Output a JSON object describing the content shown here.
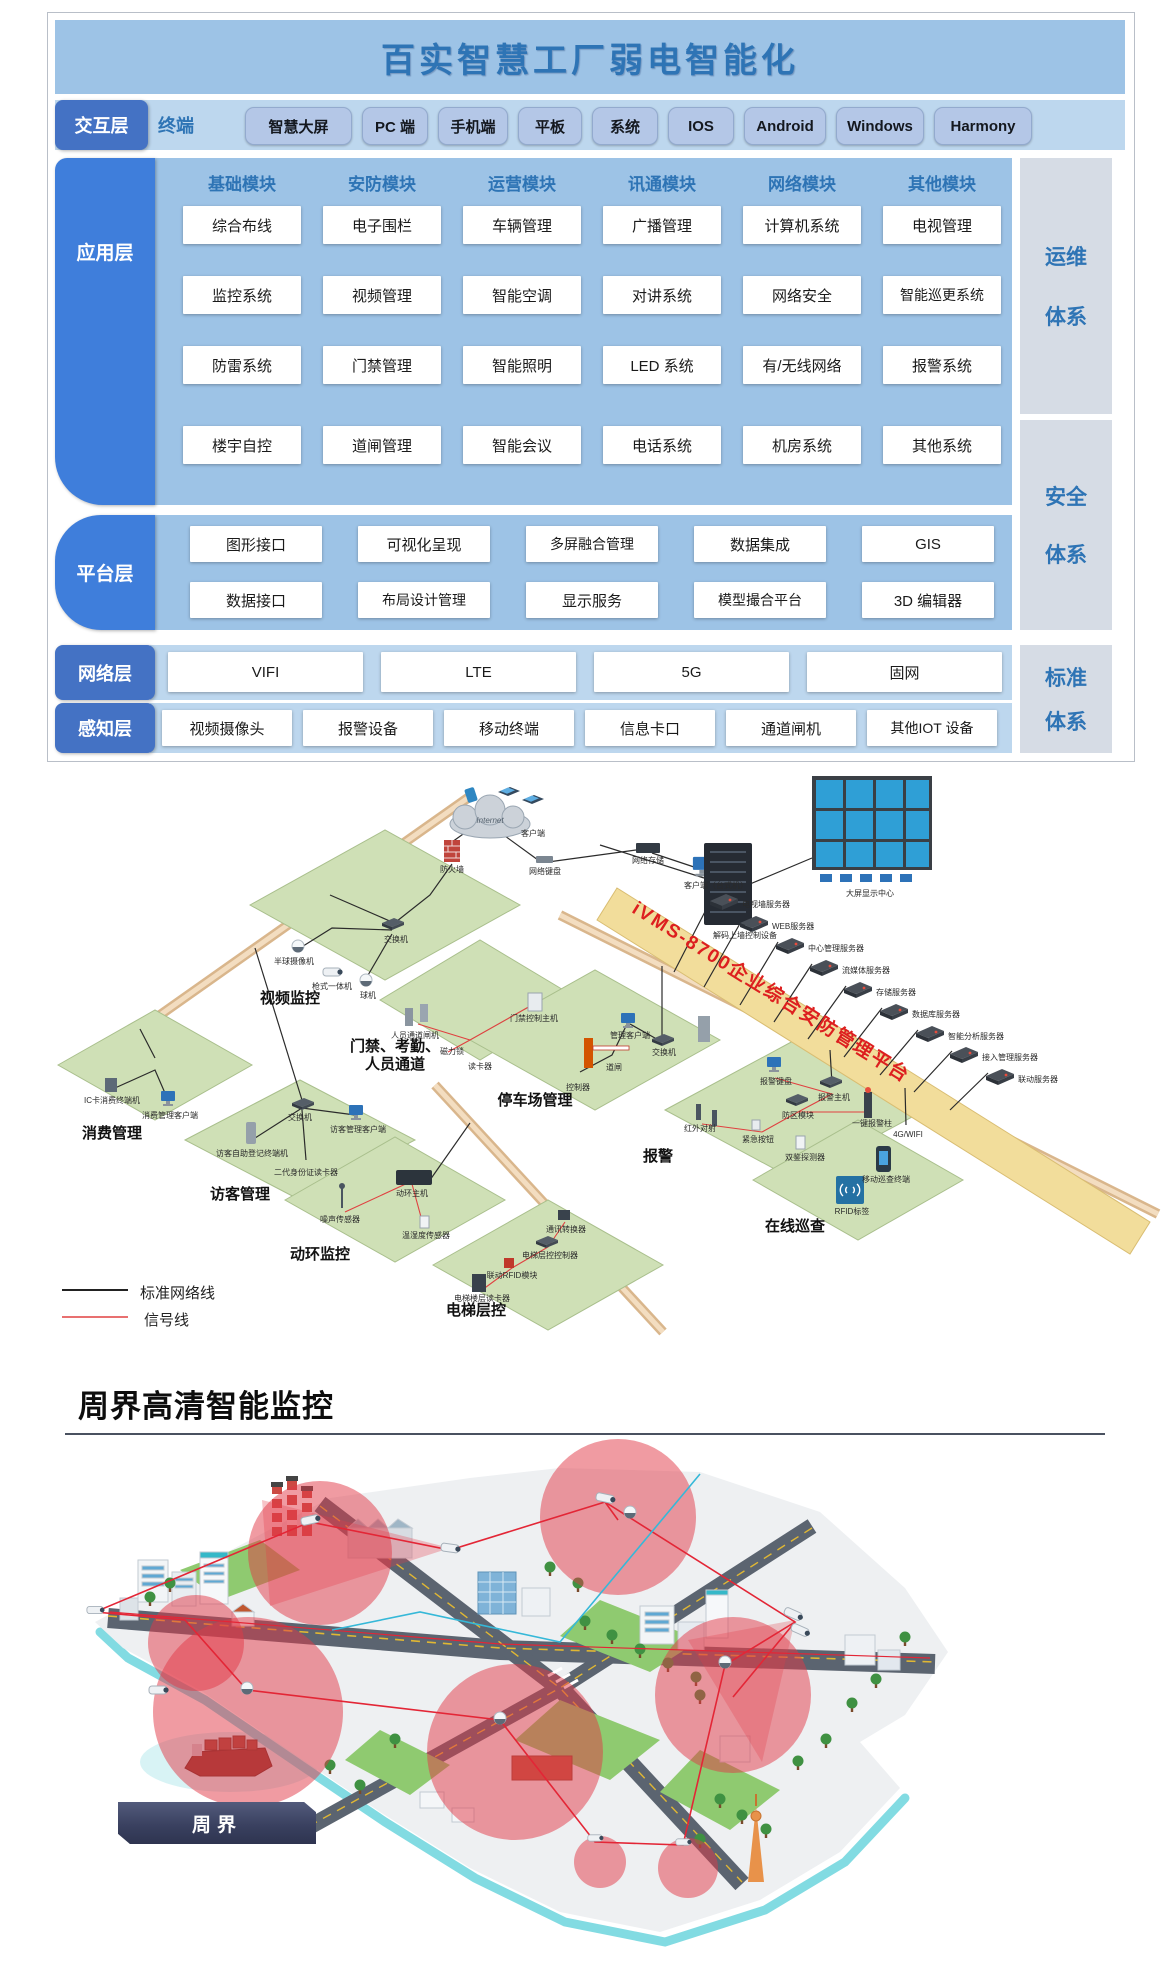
{
  "title": "百实智慧工厂弱电智能化",
  "interaction": {
    "tab": "交互层",
    "lead": "终端",
    "buttons": [
      "智慧大屏",
      "PC 端",
      "手机端",
      "平板",
      "系统",
      "IOS",
      "Android",
      "Windows",
      "Harmony"
    ]
  },
  "application": {
    "tab": "应用层",
    "columns": [
      {
        "header": "基础模块",
        "cells": [
          "综合布线",
          "监控系统",
          "防雷系统",
          "楼宇自控"
        ]
      },
      {
        "header": "安防模块",
        "cells": [
          "电子围栏",
          "视频管理",
          "门禁管理",
          "道闸管理"
        ]
      },
      {
        "header": "运营模块",
        "cells": [
          "车辆管理",
          "智能空调",
          "智能照明",
          "智能会议"
        ]
      },
      {
        "header": "讯通模块",
        "cells": [
          "广播管理",
          "对讲系统",
          "LED 系统",
          "电话系统"
        ]
      },
      {
        "header": "网络模块",
        "cells": [
          "计算机系统",
          "网络安全",
          "有/无线网络",
          "机房系统"
        ]
      },
      {
        "header": "其他模块",
        "cells": [
          "电视管理",
          "智能巡更系统",
          "报警系统",
          "其他系统"
        ]
      }
    ]
  },
  "platform": {
    "tab": "平台层",
    "row1": [
      "图形接口",
      "可视化呈现",
      "多屏融合管理",
      "数据集成",
      "GIS"
    ],
    "row2": [
      "数据接口",
      "布局设计管理",
      "显示服务",
      "模型撮合平台",
      "3D 编辑器"
    ]
  },
  "network": {
    "tab": "网络层",
    "items": [
      "VIFI",
      "LTE",
      "5G",
      "固网"
    ]
  },
  "perception": {
    "tab": "感知层",
    "items": [
      "视频摄像头",
      "报警设备",
      "移动终端",
      "信息卡口",
      "通道闸机",
      "其他IOT 设备"
    ]
  },
  "systems": [
    {
      "l1": "运维",
      "l2": "体系"
    },
    {
      "l1": "安全",
      "l2": "体系"
    },
    {
      "l1": "标准",
      "l2": "体系"
    }
  ],
  "topology": {
    "banner": "iVMS-8700企业综合安防管理平台",
    "cloud": "Internet",
    "zones": [
      "视频监控",
      "门禁、考勤、人员通道",
      "消费管理",
      "访客管理",
      "停车场管理",
      "报警",
      "在线巡查",
      "动环监控",
      "电梯层控"
    ],
    "servers": [
      "电视墙服务器",
      "WEB服务器",
      "中心管理服务器",
      "流媒体服务器",
      "存储服务器",
      "数据库服务器",
      "智能分析服务器",
      "接入管理服务器",
      "联动服务器"
    ],
    "devices": [
      "客户端",
      "防火墙",
      "网络键盘",
      "网络存储",
      "客户端（台式机）",
      "解码上墙控制设备",
      "大屏显示中心",
      "交换机",
      "半球摄像机",
      "枪式一体机",
      "球机",
      "人员通道闸机",
      "磁力锁",
      "读卡器",
      "门禁控制主机",
      "IC卡消费终端机",
      "消费管理客户端",
      "交换机",
      "访客管理客户端",
      "访客自助登记终端机",
      "二代身份证读卡器",
      "管理客户端",
      "交换机",
      "道闸",
      "控制器",
      "报警键盘",
      "报警主机",
      "防区模块",
      "一键报警柱",
      "红外对射",
      "紧急按钮",
      "双鉴探测器",
      "4G/WIFI",
      "移动巡查终端",
      "RFID标签",
      "动环主机",
      "噪声传感器",
      "温湿度传感器",
      "通讯转换器",
      "电梯层控控制器",
      "联动RFID模块",
      "电梯楼层读卡器"
    ],
    "legend": [
      {
        "label": "标准网络线",
        "color": "#222222"
      },
      {
        "label": "信号线",
        "color": "#e04040"
      }
    ]
  },
  "perimeter": {
    "heading": "周界高清智能监控",
    "badge": "周界"
  },
  "colors": {
    "title_bg": "#9DC3E6",
    "band_bg": "#BDD7EE",
    "panel_bg": "#9DC3E6",
    "tab_blue": "#4472C4",
    "tab_bright": "#3F7EDB",
    "accent_text": "#2E74B5",
    "side_bg": "#D6DCE5",
    "banner_bg": "#F2DD9B",
    "banner_text": "#DD1F1F",
    "zone_green": "#CFE0B6",
    "detect_red": "#E13746",
    "coast_teal": "#82DBE2"
  }
}
